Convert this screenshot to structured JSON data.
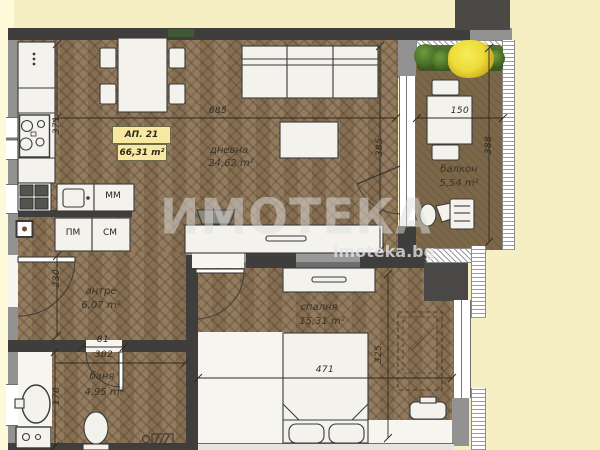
{
  "plan": {
    "apartment": {
      "label": "АП. 21",
      "area": "66,31 m²"
    },
    "rooms": {
      "living": {
        "name": "дневна",
        "area": "24,62 m²"
      },
      "balcony": {
        "name": "балкон",
        "area": "5,54 m²"
      },
      "hall": {
        "name": "антре",
        "area": "6,07 m²"
      },
      "bath": {
        "name": "баня",
        "area": "4,95 m²"
      },
      "bedroom": {
        "name": "спалня",
        "area": "15,31 m²"
      }
    },
    "appliances": {
      "mm": "ММ",
      "pm": "ПМ",
      "sm": "СМ"
    },
    "dims": {
      "living_width": "685",
      "kitchen_depth": "371",
      "living_depth": "385",
      "balcony_width": "150",
      "balcony_depth": "388",
      "hall_depth": "230",
      "bath_door": "81",
      "bath_width": "302",
      "bath_depth": "170",
      "bedroom_width": "471",
      "bedroom_depth": "325"
    },
    "watermark": {
      "brand": "ИМОТЕКА",
      "site": "imoteka.bg"
    },
    "colors": {
      "paper": "#F7EFC4",
      "floor": "#8C7456",
      "balcony_floor": "#7D6749",
      "wall_dark": "#3F3E3C",
      "wall_gray": "#929292",
      "label_bg": "#F7E9A2",
      "plant_green": "#4E7A2A",
      "flower_yellow": "#EDD93F"
    }
  }
}
